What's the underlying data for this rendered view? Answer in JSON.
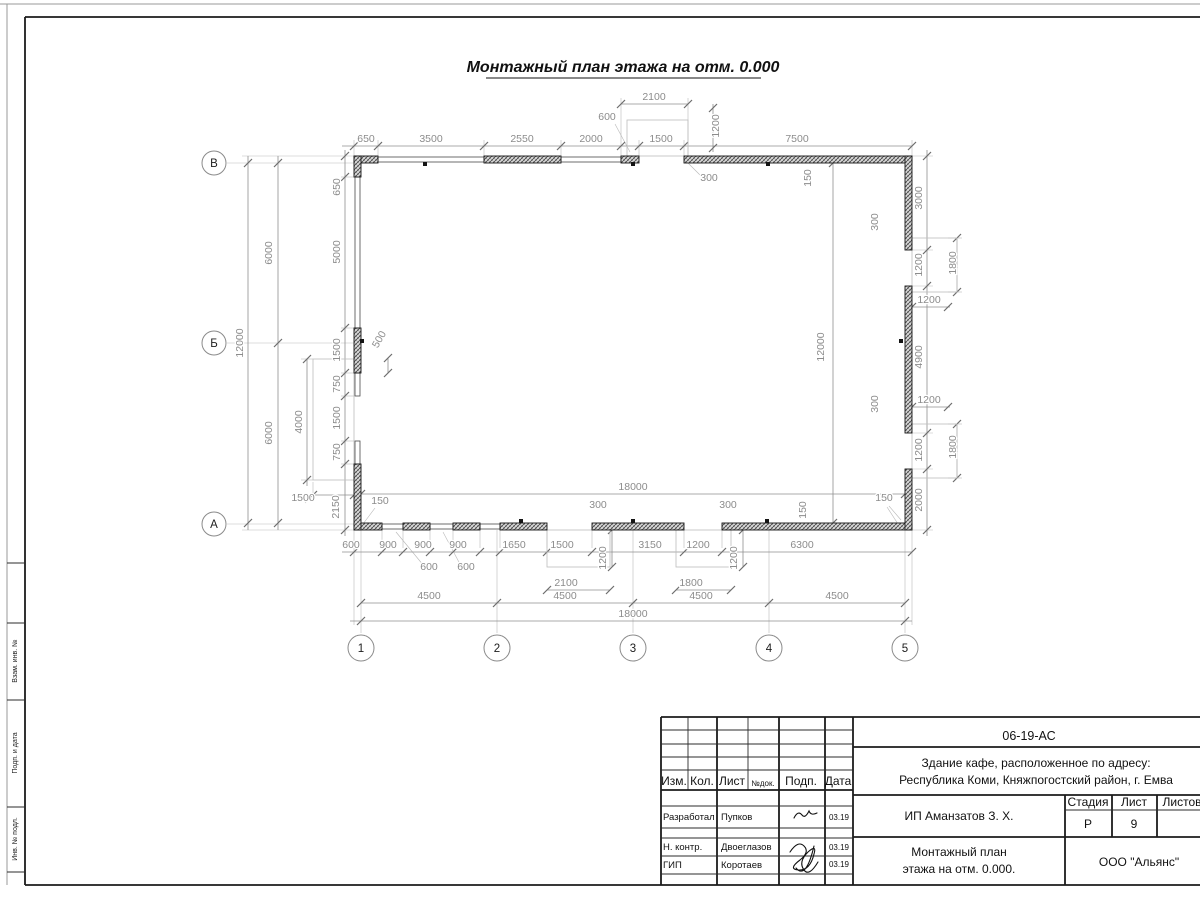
{
  "page_title": "Монтажный план этажа на отм. 0.000",
  "margin": {
    "labels": [
      "Взам. инв. №",
      "Подп. и дата",
      "Инв. № подл."
    ]
  },
  "plan": {
    "axis_rows": [
      {
        "label": "В",
        "x": 214,
        "y": 163
      },
      {
        "label": "Б",
        "x": 214,
        "y": 343
      },
      {
        "label": "А",
        "x": 214,
        "y": 524
      }
    ],
    "axis_cols": [
      {
        "label": "1",
        "x": 361,
        "y": 648
      },
      {
        "label": "2",
        "x": 497,
        "y": 648
      },
      {
        "label": "3",
        "x": 633,
        "y": 648
      },
      {
        "label": "4",
        "x": 769,
        "y": 648
      },
      {
        "label": "5",
        "x": 905,
        "y": 648
      }
    ],
    "walls_hatched": [
      [
        354,
        156,
        24,
        7
      ],
      [
        484,
        156,
        77,
        7
      ],
      [
        621,
        156,
        18,
        7
      ],
      [
        684,
        156,
        228,
        7
      ],
      [
        354,
        523,
        28,
        7
      ],
      [
        403,
        523,
        27,
        7
      ],
      [
        453,
        523,
        27,
        7
      ],
      [
        500,
        523,
        47,
        7
      ],
      [
        592,
        523,
        92,
        7
      ],
      [
        722,
        523,
        190,
        7
      ],
      [
        354,
        156,
        7,
        21
      ],
      [
        354,
        328,
        7,
        45
      ],
      [
        354,
        464,
        7,
        66
      ],
      [
        905,
        156,
        7,
        94
      ],
      [
        905,
        286,
        7,
        147
      ],
      [
        905,
        469,
        7,
        61
      ]
    ],
    "windows": [
      [
        378,
        157,
        106,
        5
      ],
      [
        561,
        157,
        60,
        5
      ],
      [
        382,
        524,
        21,
        5
      ],
      [
        430,
        524,
        23,
        5
      ],
      [
        480,
        524,
        20,
        5
      ],
      [
        355,
        177,
        5,
        151
      ],
      [
        355,
        373,
        5,
        23
      ],
      [
        355,
        441,
        5,
        23
      ]
    ],
    "porches": [
      [
        313,
        359,
        41,
        121
      ],
      [
        627,
        120,
        61,
        36
      ],
      [
        912,
        238,
        45,
        54
      ],
      [
        912,
        424,
        45,
        54
      ],
      [
        547,
        530,
        63,
        37
      ],
      [
        676,
        530,
        55,
        37
      ]
    ],
    "squares": [
      [
        425,
        164
      ],
      [
        633,
        164
      ],
      [
        768,
        164
      ],
      [
        521,
        521
      ],
      [
        633,
        521
      ],
      [
        767,
        521
      ],
      [
        901,
        341
      ],
      [
        362,
        341
      ]
    ],
    "dim_lines": [
      [
        342,
        146,
        912,
        146
      ],
      [
        621,
        104,
        688,
        104
      ],
      [
        713,
        104,
        713,
        152
      ],
      [
        342,
        552,
        912,
        552
      ],
      [
        547,
        590,
        610,
        590
      ],
      [
        676,
        590,
        731,
        590
      ],
      [
        361,
        603,
        905,
        603
      ],
      [
        350,
        621,
        912,
        621
      ],
      [
        361,
        494,
        905,
        494
      ],
      [
        833,
        163,
        833,
        523
      ],
      [
        345,
        150,
        345,
        536
      ],
      [
        248,
        156,
        248,
        530
      ],
      [
        278,
        156,
        278,
        530
      ],
      [
        307,
        359,
        307,
        486
      ],
      [
        308,
        495,
        356,
        495
      ],
      [
        388,
        358,
        388,
        373
      ],
      [
        927,
        150,
        927,
        536
      ],
      [
        957,
        238,
        957,
        292
      ],
      [
        957,
        424,
        957,
        478
      ],
      [
        905,
        307,
        950,
        307
      ],
      [
        905,
        407,
        950,
        407
      ],
      [
        612,
        530,
        612,
        567
      ],
      [
        743,
        530,
        743,
        567
      ]
    ],
    "ext_lines": [
      [
        354,
        156,
        354,
        140
      ],
      [
        378,
        156,
        378,
        140
      ],
      [
        484,
        156,
        484,
        140
      ],
      [
        561,
        156,
        561,
        140
      ],
      [
        639,
        156,
        639,
        140
      ],
      [
        684,
        156,
        684,
        140
      ],
      [
        912,
        156,
        912,
        140
      ],
      [
        621,
        156,
        621,
        98
      ],
      [
        688,
        156,
        688,
        98
      ],
      [
        354,
        163,
        227,
        163
      ],
      [
        354,
        343,
        227,
        343
      ],
      [
        354,
        524,
        227,
        524
      ],
      [
        354,
        156,
        242,
        156
      ],
      [
        354,
        530,
        242,
        530
      ],
      [
        354,
        177,
        341,
        177
      ],
      [
        354,
        328,
        341,
        328
      ],
      [
        354,
        373,
        341,
        373
      ],
      [
        354,
        396,
        341,
        396
      ],
      [
        354,
        441,
        341,
        441
      ],
      [
        354,
        464,
        341,
        464
      ],
      [
        313,
        359,
        301,
        359
      ],
      [
        313,
        480,
        301,
        480
      ],
      [
        313,
        482,
        313,
        499
      ],
      [
        912,
        250,
        933,
        250
      ],
      [
        912,
        286,
        933,
        286
      ],
      [
        912,
        433,
        933,
        433
      ],
      [
        912,
        469,
        933,
        469
      ],
      [
        912,
        156,
        933,
        156
      ],
      [
        912,
        530,
        933,
        530
      ],
      [
        948,
        238,
        962,
        238
      ],
      [
        948,
        292,
        962,
        292
      ],
      [
        948,
        424,
        962,
        424
      ],
      [
        948,
        478,
        962,
        478
      ],
      [
        382,
        530,
        382,
        548
      ],
      [
        403,
        530,
        403,
        548
      ],
      [
        430,
        530,
        430,
        548
      ],
      [
        453,
        530,
        453,
        548
      ],
      [
        480,
        530,
        480,
        548
      ],
      [
        500,
        530,
        500,
        548
      ],
      [
        547,
        530,
        547,
        548
      ],
      [
        592,
        530,
        592,
        548
      ],
      [
        684,
        530,
        684,
        548
      ],
      [
        722,
        530,
        722,
        548
      ],
      [
        361,
        530,
        361,
        633
      ],
      [
        497,
        530,
        497,
        633
      ],
      [
        633,
        530,
        633,
        633
      ],
      [
        769,
        530,
        769,
        633
      ],
      [
        905,
        530,
        905,
        633
      ],
      [
        354,
        530,
        354,
        625
      ],
      [
        912,
        530,
        912,
        625
      ]
    ],
    "leaders": [
      [
        396,
        532,
        424,
        566
      ],
      [
        443,
        532,
        461,
        566
      ],
      [
        630,
        152,
        615,
        124
      ],
      [
        687,
        162,
        701,
        176
      ],
      [
        363,
        524,
        375,
        508
      ],
      [
        898,
        524,
        887,
        507
      ],
      [
        313,
        495,
        305,
        503
      ],
      [
        901,
        520,
        889,
        506
      ]
    ],
    "ticks": [
      [
        354,
        146
      ],
      [
        378,
        146
      ],
      [
        484,
        146
      ],
      [
        561,
        146
      ],
      [
        621,
        146
      ],
      [
        639,
        146
      ],
      [
        684,
        146
      ],
      [
        912,
        146
      ],
      [
        621,
        104
      ],
      [
        688,
        104
      ],
      [
        713,
        108
      ],
      [
        713,
        148
      ],
      [
        354,
        552
      ],
      [
        382,
        552
      ],
      [
        403,
        552
      ],
      [
        430,
        552
      ],
      [
        453,
        552
      ],
      [
        480,
        552
      ],
      [
        500,
        552
      ],
      [
        547,
        552
      ],
      [
        592,
        552
      ],
      [
        684,
        552
      ],
      [
        722,
        552
      ],
      [
        912,
        552
      ],
      [
        547,
        590
      ],
      [
        610,
        590
      ],
      [
        676,
        590
      ],
      [
        731,
        590
      ],
      [
        361,
        603
      ],
      [
        497,
        603
      ],
      [
        633,
        603
      ],
      [
        769,
        603
      ],
      [
        905,
        603
      ],
      [
        361,
        621
      ],
      [
        905,
        621
      ],
      [
        361,
        494
      ],
      [
        905,
        494
      ],
      [
        833,
        163
      ],
      [
        833,
        523
      ],
      [
        345,
        156
      ],
      [
        345,
        177
      ],
      [
        345,
        328
      ],
      [
        345,
        373
      ],
      [
        345,
        396
      ],
      [
        345,
        441
      ],
      [
        345,
        464
      ],
      [
        345,
        530
      ],
      [
        248,
        163
      ],
      [
        248,
        523
      ],
      [
        278,
        163
      ],
      [
        278,
        343
      ],
      [
        278,
        523
      ],
      [
        307,
        359
      ],
      [
        307,
        480
      ],
      [
        313,
        495
      ],
      [
        354,
        495
      ],
      [
        388,
        358
      ],
      [
        388,
        373
      ],
      [
        927,
        156
      ],
      [
        927,
        250
      ],
      [
        927,
        286
      ],
      [
        927,
        433
      ],
      [
        927,
        469
      ],
      [
        927,
        530
      ],
      [
        957,
        238
      ],
      [
        957,
        292
      ],
      [
        957,
        424
      ],
      [
        957,
        478
      ],
      [
        912,
        307
      ],
      [
        948,
        307
      ],
      [
        912,
        407
      ],
      [
        948,
        407
      ],
      [
        612,
        530
      ],
      [
        612,
        567
      ],
      [
        743,
        530
      ],
      [
        743,
        567
      ]
    ],
    "dims": [
      {
        "t": "650",
        "x": 366,
        "y": 142
      },
      {
        "t": "3500",
        "x": 431,
        "y": 142
      },
      {
        "t": "2550",
        "x": 522,
        "y": 142
      },
      {
        "t": "2000",
        "x": 591,
        "y": 142
      },
      {
        "t": "1500",
        "x": 661,
        "y": 142
      },
      {
        "t": "7500",
        "x": 797,
        "y": 142
      },
      {
        "t": "2100",
        "x": 654,
        "y": 100
      },
      {
        "t": "600",
        "x": 607,
        "y": 120
      },
      {
        "t": "1200",
        "x": 719,
        "y": 126,
        "r": -90
      },
      {
        "t": "300",
        "x": 709,
        "y": 181
      },
      {
        "t": "150",
        "x": 811,
        "y": 178,
        "r": -90
      },
      {
        "t": "12000",
        "x": 243,
        "y": 343,
        "r": -90
      },
      {
        "t": "6000",
        "x": 272,
        "y": 253,
        "r": -90
      },
      {
        "t": "6000",
        "x": 272,
        "y": 433,
        "r": -90
      },
      {
        "t": "650",
        "x": 340,
        "y": 187,
        "r": -90
      },
      {
        "t": "5000",
        "x": 340,
        "y": 252,
        "r": -90
      },
      {
        "t": "1500",
        "x": 340,
        "y": 350,
        "r": -90
      },
      {
        "t": "750",
        "x": 340,
        "y": 384,
        "r": -90
      },
      {
        "t": "1500",
        "x": 340,
        "y": 418,
        "r": -90
      },
      {
        "t": "750",
        "x": 340,
        "y": 452,
        "r": -90
      },
      {
        "t": "2150",
        "x": 339,
        "y": 507,
        "r": -90
      },
      {
        "t": "4000",
        "x": 302,
        "y": 422,
        "r": -90
      },
      {
        "t": "1500",
        "x": 303,
        "y": 501
      },
      {
        "t": "500",
        "x": 382,
        "y": 341,
        "r": -60
      },
      {
        "t": "3000",
        "x": 922,
        "y": 198,
        "r": -90
      },
      {
        "t": "1200",
        "x": 922,
        "y": 265,
        "r": -90
      },
      {
        "t": "4900",
        "x": 922,
        "y": 357,
        "r": -90
      },
      {
        "t": "1200",
        "x": 922,
        "y": 450,
        "r": -90
      },
      {
        "t": "2000",
        "x": 922,
        "y": 500,
        "r": -90
      },
      {
        "t": "300",
        "x": 878,
        "y": 222,
        "r": -90
      },
      {
        "t": "300",
        "x": 878,
        "y": 404,
        "r": -90
      },
      {
        "t": "1800",
        "x": 956,
        "y": 263,
        "r": -90
      },
      {
        "t": "1800",
        "x": 956,
        "y": 447,
        "r": -90
      },
      {
        "t": "1200",
        "x": 929,
        "y": 303
      },
      {
        "t": "1200",
        "x": 929,
        "y": 403
      },
      {
        "t": "150",
        "x": 884,
        "y": 501
      },
      {
        "t": "600",
        "x": 351,
        "y": 548
      },
      {
        "t": "900",
        "x": 388,
        "y": 548
      },
      {
        "t": "900",
        "x": 423,
        "y": 548
      },
      {
        "t": "900",
        "x": 458,
        "y": 548
      },
      {
        "t": "1650",
        "x": 514,
        "y": 548
      },
      {
        "t": "1500",
        "x": 562,
        "y": 548
      },
      {
        "t": "3150",
        "x": 650,
        "y": 548
      },
      {
        "t": "1200",
        "x": 698,
        "y": 548
      },
      {
        "t": "6300",
        "x": 802,
        "y": 548
      },
      {
        "t": "600",
        "x": 429,
        "y": 570
      },
      {
        "t": "600",
        "x": 466,
        "y": 570
      },
      {
        "t": "2100",
        "x": 566,
        "y": 586
      },
      {
        "t": "1800",
        "x": 691,
        "y": 586
      },
      {
        "t": "1200",
        "x": 606,
        "y": 558,
        "r": -90
      },
      {
        "t": "1200",
        "x": 737,
        "y": 558,
        "r": -90
      },
      {
        "t": "4500",
        "x": 429,
        "y": 599
      },
      {
        "t": "4500",
        "x": 565,
        "y": 599
      },
      {
        "t": "4500",
        "x": 701,
        "y": 599
      },
      {
        "t": "4500",
        "x": 837,
        "y": 599
      },
      {
        "t": "18000",
        "x": 633,
        "y": 617
      },
      {
        "t": "150",
        "x": 380,
        "y": 504
      },
      {
        "t": "300",
        "x": 598,
        "y": 508
      },
      {
        "t": "300",
        "x": 728,
        "y": 508
      },
      {
        "t": "150",
        "x": 806,
        "y": 510,
        "r": -90
      },
      {
        "t": "18000",
        "x": 633,
        "y": 490
      },
      {
        "t": "12000",
        "x": 824,
        "y": 347,
        "r": -90
      }
    ]
  },
  "title_block": {
    "doc_number": "06-19-АС",
    "project_line1": "Здание кафе, расположенное по адресу:",
    "project_line2": "Республика Коми, Княжпогостский район, г. Емва",
    "client": "ИП Аманзатов З. Х.",
    "sheet_name_line1": "Монтажный план",
    "sheet_name_line2": "этажа на отм. 0.000.",
    "company": "ООО \"Альянс\"",
    "stage_label": "Стадия",
    "sheet_label": "Лист",
    "sheets_label": "Листов",
    "stage_value": "Р",
    "sheet_value": "9",
    "header_cols": [
      "Изм.",
      "Кол.",
      "Лист",
      "№док.",
      "Подп.",
      "Дата"
    ],
    "rows": [
      {
        "role": "Разработал",
        "name": "Пупков",
        "date": "03.19"
      },
      {
        "role": "Н. контр.",
        "name": "Двоеглазов",
        "date": "03.19"
      },
      {
        "role": "ГИП",
        "name": "Коротаев",
        "date": "03.19"
      }
    ]
  }
}
